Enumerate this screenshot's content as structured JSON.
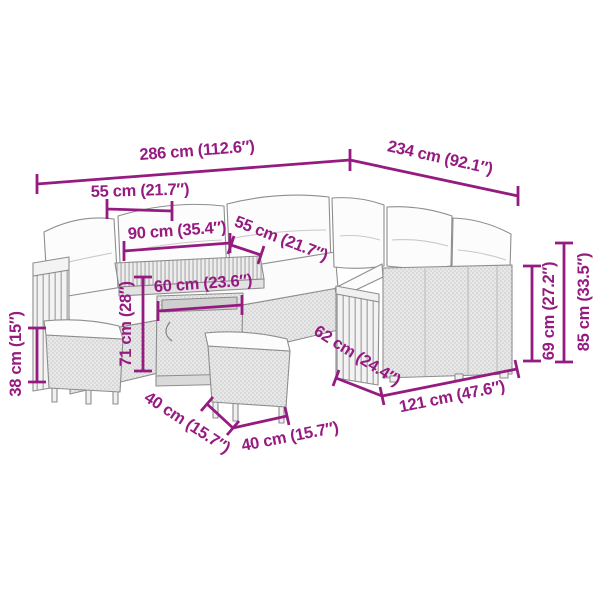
{
  "accent_color": "#951B81",
  "background_color": "#FFFFFF",
  "furniture_color": "#E8E8E8",
  "outline_color": "#8E8E8E",
  "dims": {
    "total_width": "286 cm (112.6″)",
    "total_depth": "234 cm (92.1″)",
    "seat_width_left": "55 cm (21.7″)",
    "table_top_length": "90 cm (35.4″)",
    "seat_depth": "55 cm (21.7″)",
    "table_body_width": "60 cm (23.6″)",
    "table_height": "71 cm (28″)",
    "stool_height": "38 cm (15″)",
    "stool_depth": "40 cm (15.7″)",
    "stool_width": "40 cm (15.7″)",
    "sofa_depth": "62 cm (24.4″)",
    "sofa_section_length": "121 cm (47.6″)",
    "arm_height": "69 cm (27.2″)",
    "back_height": "85 cm (33.5″)"
  }
}
